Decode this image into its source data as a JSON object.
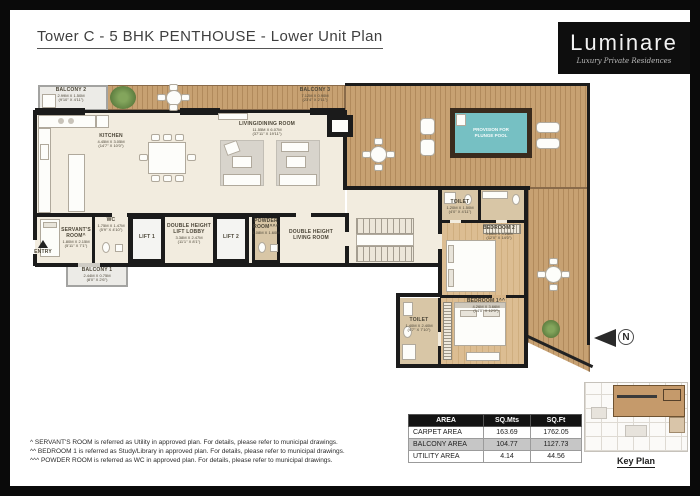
{
  "header": {
    "title": "Tower C - 5 BHK PENTHOUSE - Lower Unit Plan",
    "logo": {
      "name": "Luminare",
      "tagline": "Luxury Private Residences"
    }
  },
  "plan": {
    "labels": {
      "balcony2": {
        "n": "BALCONY 2",
        "m": "2.99M X 1.50M",
        "f": "(9'10\" X 4'11\")"
      },
      "kitchen": {
        "n": "KITCHEN",
        "m": "4.45M X 3.05M",
        "f": "(14'7\" X 10'0\")"
      },
      "living": {
        "n": "LIVING/DINING ROOM",
        "m": "11.55M X 6.07M",
        "f": "(37'11\" X 19'11\")"
      },
      "balcony3": {
        "n": "BALCONY 3",
        "m": "7.12M X 0.90M",
        "f": "(23'4\" X 2'11\")"
      },
      "pool": {
        "l1": "PROVISION FOR",
        "l2": "PLUNGE POOL"
      },
      "wc": {
        "n": "WC",
        "m": "1.75M X 1.47M",
        "f": "(5'9\" X 4'10\")"
      },
      "lift1": {
        "n": "LIFT 1"
      },
      "lift_lobby": {
        "n1": "DOUBLE HEIGHT",
        "n2": "LIFT LOBBY",
        "m": "3.38M X 2.47M",
        "f": "(11'1\" X 8'1\")"
      },
      "lift2": {
        "n": "LIFT 2"
      },
      "powder": {
        "n1": "POWDER",
        "n2": "ROOM^^^",
        "m": "1.08M X 1.60M",
        "f": "(3'6\" X 5'3\")"
      },
      "dh_living": {
        "n1": "DOUBLE HEIGHT",
        "n2": "LIVING ROOM"
      },
      "servant": {
        "n1": "SERVANT'S",
        "n2": "ROOM^",
        "m": "1.80M X 2.15M",
        "f": "(5'11\" X 7'1\")"
      },
      "entry": {
        "n": "ENTRY"
      },
      "balcony1": {
        "n": "BALCONY 1",
        "m": "2.44M X 0.75M",
        "f": "(8'0\" X 2'6\")"
      },
      "toilet2": {
        "n": "TOILET",
        "m": "1.20M X 1.50M",
        "f": "(4'0\" X 4'11\")"
      },
      "bedroom2": {
        "n": "BEDROOM 2",
        "m": "3.66M X 4.26M",
        "f": "(12'0\" X 14'0\")"
      },
      "bedroom1": {
        "n": "BEDROOM 1^^",
        "m": "4.26M X 3.66M",
        "f": "(14'0\" X 12'0\")"
      },
      "toilet1": {
        "n": "TOILET",
        "m": "1.40M X 2.40M",
        "f": "(4'7\" X 7'10\")"
      }
    }
  },
  "compass": {
    "label": "N"
  },
  "key_plan": {
    "label": "Key Plan"
  },
  "area_table": {
    "headers": [
      "AREA",
      "SQ.Mts",
      "SQ.Ft"
    ],
    "rows": [
      [
        "CARPET AREA",
        "163.69",
        "1762.05"
      ],
      [
        "BALCONY AREA",
        "104.77",
        "1127.73"
      ],
      [
        "UTILITY AREA",
        "4.14",
        "44.56"
      ]
    ]
  },
  "footnotes": [
    "^ SERVANT'S ROOM is referred as Utility in approved plan. For details, please refer to municipal drawings.",
    "^^ BEDROOM 1 is referred as Study/Library in approved plan. For details, please refer to municipal drawings.",
    "^^^ POWDER ROOM is referred as WC in approved plan. For details, please refer to municipal drawings."
  ],
  "colors": {
    "wall": "#1b1b1b",
    "deck_wood": "#c7a172",
    "pool": "#76c0c3",
    "floor": "#f2ecdf",
    "bath_floor": "#d8c6a6",
    "table_header_bg": "#131313",
    "table_alt_row_bg": "#c6c6c6",
    "logo_bg": "#0e0e0e"
  }
}
